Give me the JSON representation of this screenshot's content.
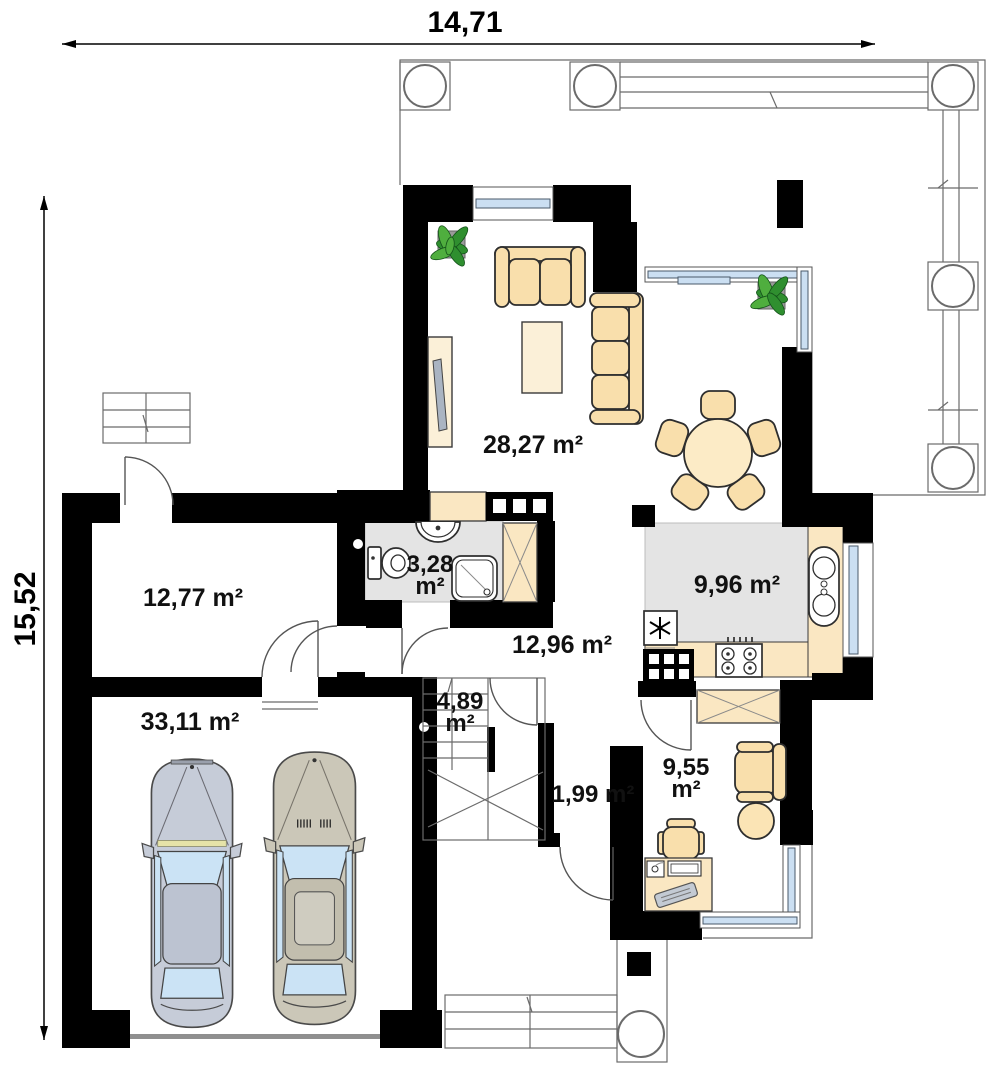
{
  "plan": {
    "dimensions": {
      "width_label": "14,71",
      "height_label": "15,52"
    },
    "rooms": {
      "living_room": {
        "label": "28,27 m²"
      },
      "room_left": {
        "label": "12,77 m²"
      },
      "bathroom": {
        "line1": "3,28",
        "line2": "m²"
      },
      "kitchen": {
        "label": "9,96 m²"
      },
      "hall": {
        "label": "12,96 m²"
      },
      "staircase": {
        "line1": "4,89",
        "line2": "m²"
      },
      "vestibule": {
        "label": "1,99 m²"
      },
      "office": {
        "line1": "9,55",
        "line2": "m²"
      },
      "garage": {
        "label": "33,11 m²"
      }
    },
    "colors": {
      "wall": "#000000",
      "furniture": "#F9DFAC",
      "floor_gray": "#E4E4E4",
      "glass_blue": "#CBDFF2",
      "car_left": "#C6CCD8",
      "car_right": "#CBC7B8",
      "plant_green": "#2F8F2F"
    }
  }
}
